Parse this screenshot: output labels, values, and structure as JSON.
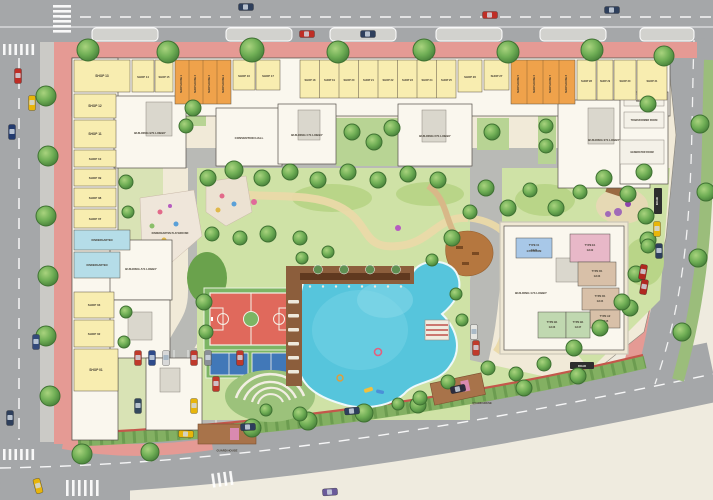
{
  "site": {
    "shops_left": [
      "SHOP 13",
      "SHOP 12",
      "SHOP 11",
      "SHOP 10",
      "SHOP 09",
      "SHOP 08",
      "SHOP 07",
      "SHOP 03",
      "SHOP 02",
      "SHOP 01"
    ],
    "shops_top": [
      "SHOP 14",
      "SHOP 15",
      "SHOP 16",
      "SHOP 17",
      "SHOP 18",
      "SHOP 19",
      "SHOP 20",
      "SHOP 21",
      "SHOP 22",
      "SHOP 23",
      "SHOP 24",
      "SHOP 25",
      "SHOP 26",
      "SHOP 27",
      "SHOP 28",
      "SHOP 29",
      "SHOP 30",
      "SHOP 31"
    ],
    "shop_houses": [
      "SHOP HOUSE 1",
      "SHOP HOUSE 2",
      "SHOP HOUSE 3",
      "SHOP HOUSE 4",
      "SHOP HOUSE 5",
      "SHOP HOUSE 6",
      "SHOP HOUSE 7",
      "SHOP HOUSE 8"
    ],
    "lobbies": {
      "a": "BUILDING A'S LOBBY",
      "b": "BUILDING B'S LOBBY",
      "c": "BUILDING C'S LOBBY",
      "d": "BUILDING D'S LOBBY",
      "e": "BUILDING E'S LOBBY",
      "g": "BUILDING G'S LOBBY"
    },
    "rooms": {
      "convention": "CONVENTION HALL",
      "kindergarten1": "KINDERGARTEN",
      "kindergarten2": "KINDERGARTEN",
      "gym": "GYM ROOM",
      "trash": "TRASH ROOM",
      "transformer": "TRANSFORMER ROOM",
      "generator": "GENERATOR ROOM"
    },
    "outdoor": {
      "kindergarten_playground": "KINDERGARTEN PLAYGROUND",
      "guard_house_south": "GUARD HOUSE",
      "guard_house_east": "GUARD HOUSE",
      "road_badge": "ROAD"
    },
    "units_g": [
      {
        "type": "TYPE 01",
        "code": "G2.01"
      },
      {
        "type": "TYPE E1",
        "code": "G2.02"
      },
      {
        "type": "TYPE D1",
        "code": "G2.03"
      },
      {
        "type": "TYPE D1",
        "code": "G2.04"
      },
      {
        "type": "TYPE A2",
        "code": "G2.05"
      },
      {
        "type": "TYPE B1",
        "code": "G2.06"
      },
      {
        "type": "TYPE B1",
        "code": "G2.07"
      }
    ],
    "colors": {
      "sidewalk": "#e59a94",
      "road": "#a5a7a9",
      "shop": "#f8edb0",
      "shop_house": "#efa24b",
      "kindergarten": "#b5dde8",
      "pool": "#56c5dc",
      "basketball_court": "#e0695c",
      "tennis_court": "#4178b8",
      "sport_green": "#7cb564",
      "garden": "#cfe2a6"
    }
  }
}
